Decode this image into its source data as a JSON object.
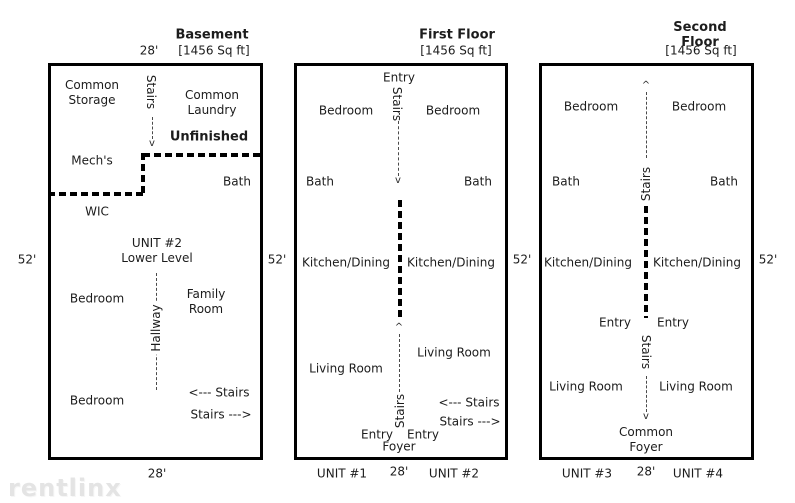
{
  "watermark": "rentlinx",
  "shared": {
    "sqft": "[1456 Sq ft]",
    "width_label": "28'",
    "height_label": "52'"
  },
  "glyphs": {
    "arrow_up": "^",
    "arrow_down": "v"
  },
  "basement": {
    "title": "Basement",
    "rooms": {
      "common_storage": "Common\nStorage",
      "stairs_top": "Stairs",
      "common_laundry": "Common\nLaundry",
      "unfinished": "Unfinished",
      "mechs": "Mech's",
      "bath": "Bath",
      "wic": "WIC",
      "unit2_lower": "UNIT #2\nLower Level",
      "hallway": "Hallway",
      "bedroom_upper": "Bedroom",
      "family_room": "Family\nRoom",
      "bedroom_lower": "Bedroom",
      "stairs_left": "<--- Stairs",
      "stairs_right": "Stairs --->"
    }
  },
  "first_floor": {
    "title": "First Floor",
    "unit_left": "UNIT #1",
    "unit_right": "UNIT #2",
    "rooms": {
      "entry_top": "Entry",
      "stairs_top": "Stairs",
      "bedroom_left": "Bedroom",
      "bedroom_right": "Bedroom",
      "bath_left": "Bath",
      "bath_right": "Bath",
      "kitchen_left": "Kitchen/Dining",
      "kitchen_right": "Kitchen/Dining",
      "living_left": "Living Room",
      "living_right": "Living Room",
      "stairs_bottom": "Stairs",
      "stairs_left": "<--- Stairs",
      "stairs_right": "Stairs --->",
      "entry_left": "Entry",
      "entry_right": "Entry",
      "foyer": "Foyer"
    }
  },
  "second_floor": {
    "title": "Second Floor",
    "unit_left": "UNIT #3",
    "unit_right": "UNIT #4",
    "rooms": {
      "stairs_top": "Stairs",
      "bedroom_left": "Bedroom",
      "bedroom_right": "Bedroom",
      "bath_left": "Bath",
      "bath_right": "Bath",
      "kitchen_left": "Kitchen/Dining",
      "kitchen_right": "Kitchen/Dining",
      "entry_left": "Entry",
      "entry_right": "Entry",
      "stairs_bottom": "Stairs",
      "living_left": "Living Room",
      "living_right": "Living Room",
      "common_foyer": "Common\nFoyer"
    }
  }
}
